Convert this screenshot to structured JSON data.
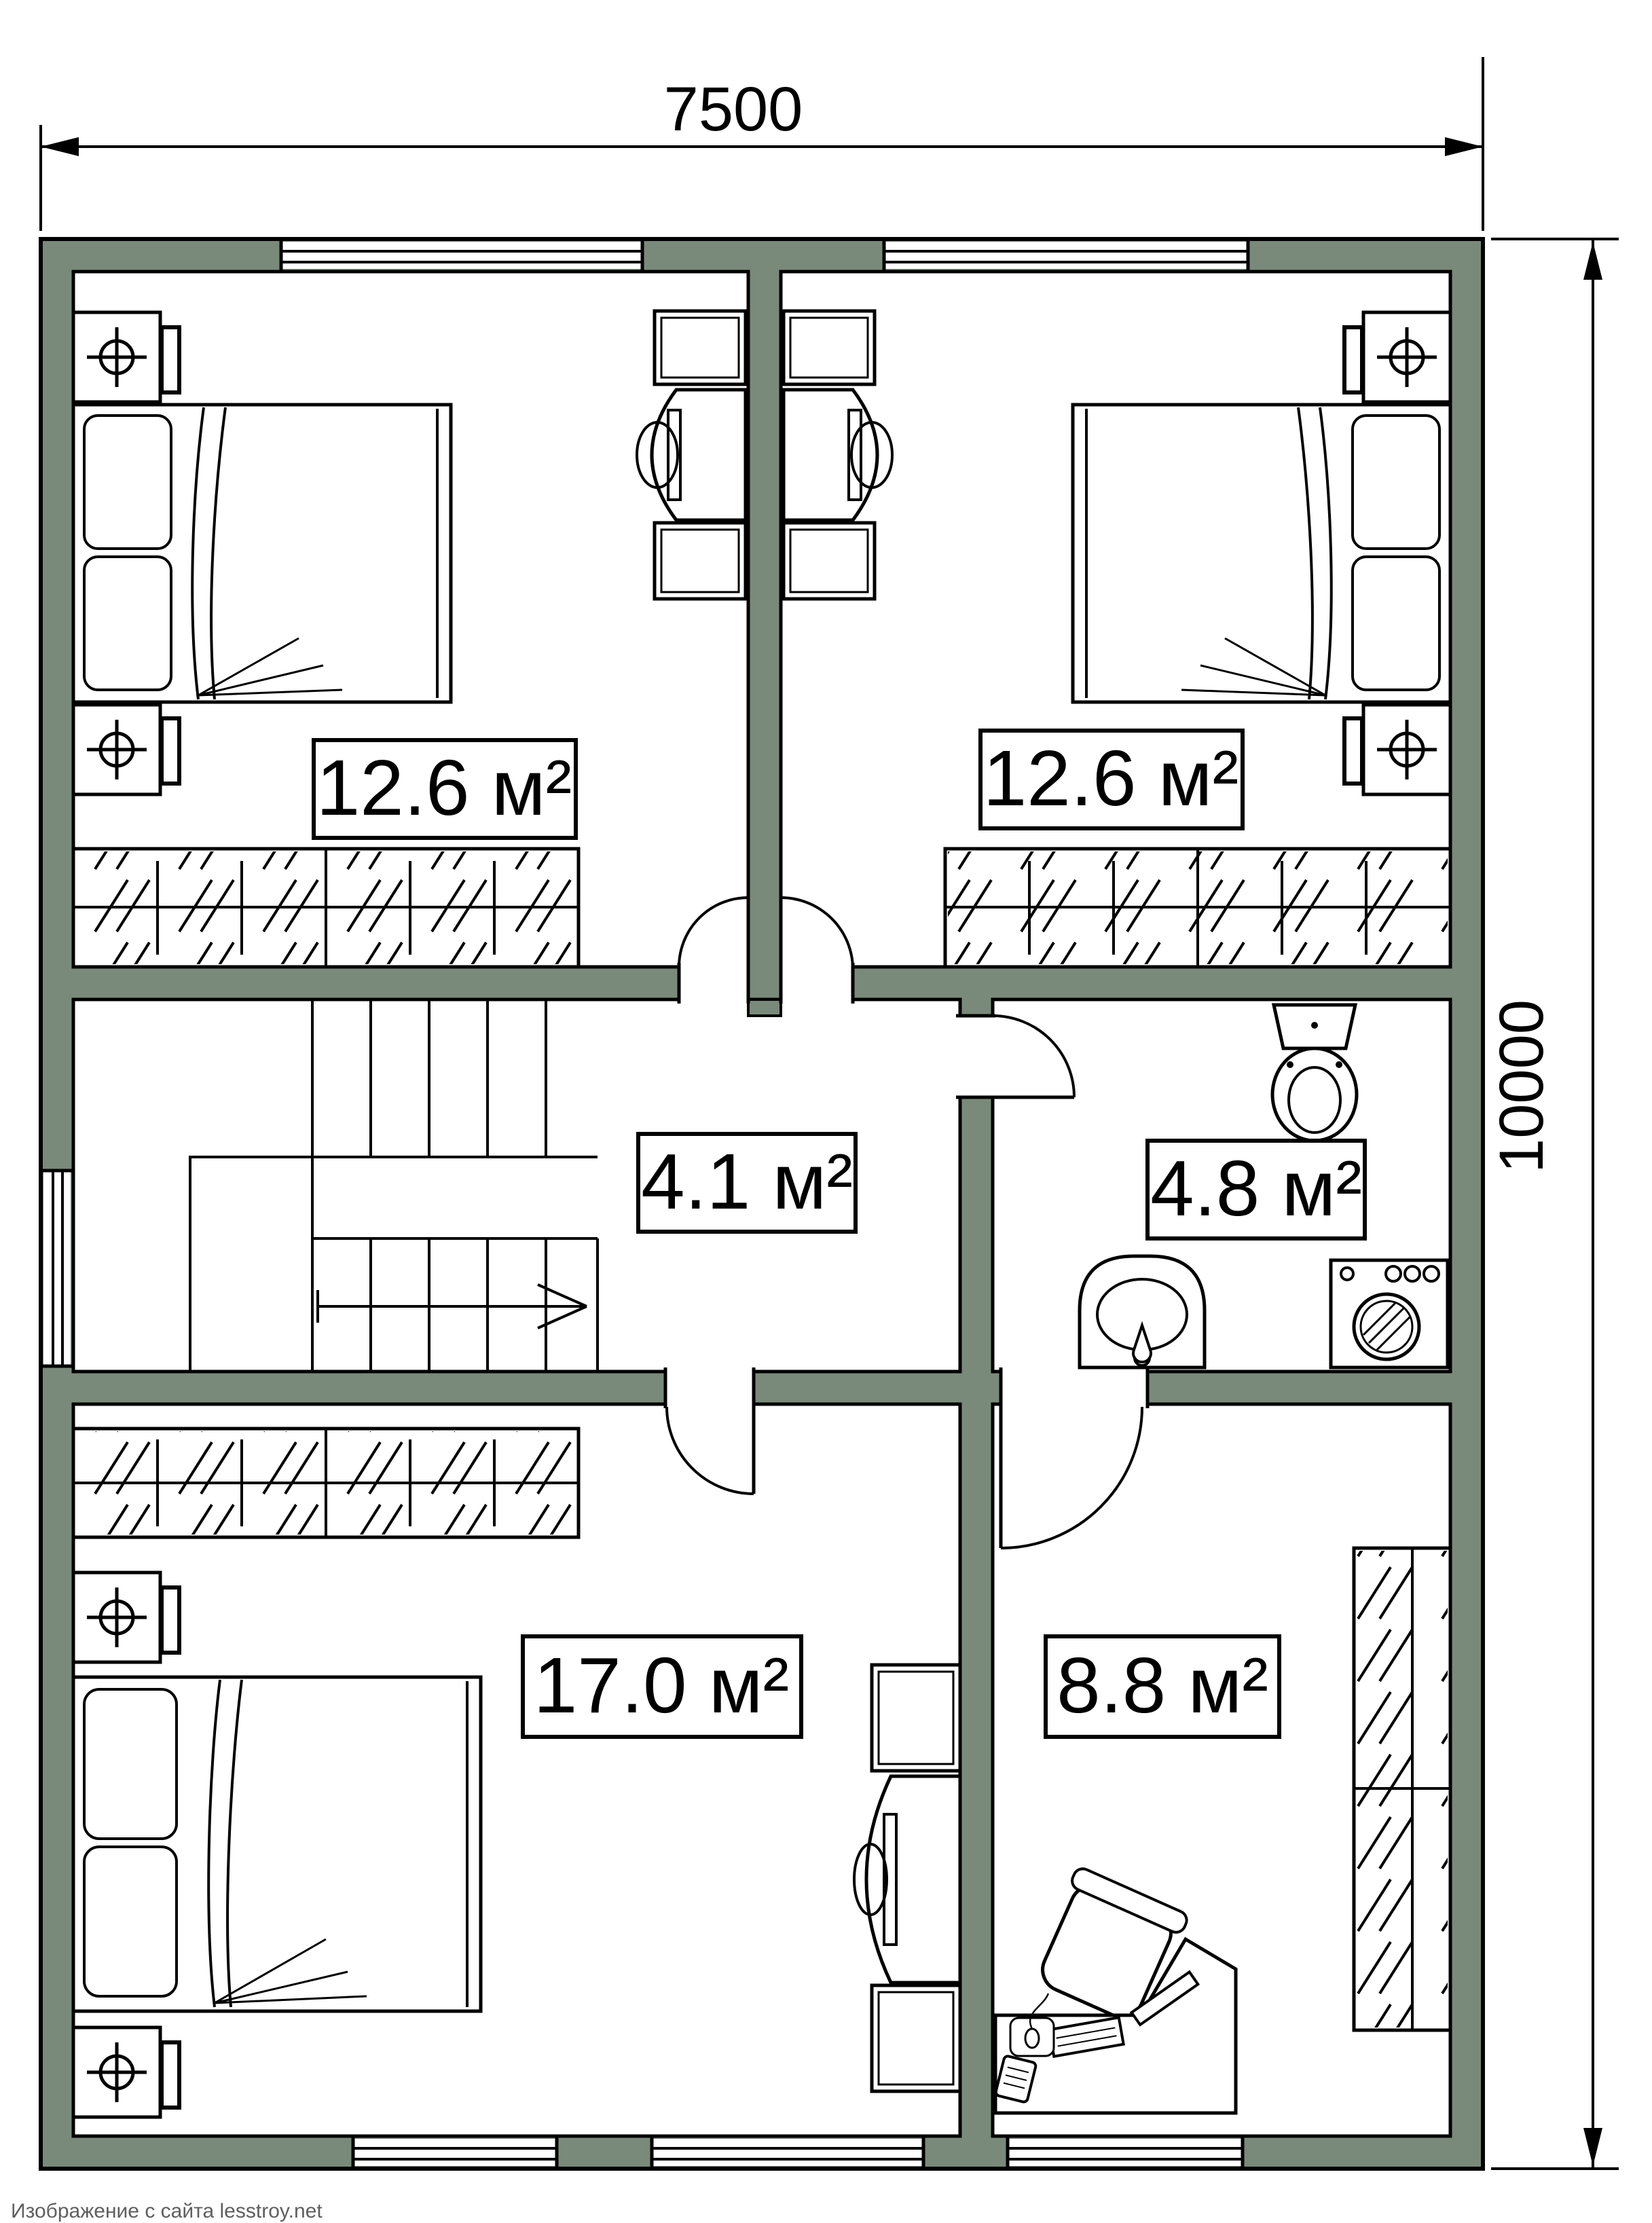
{
  "plan": {
    "type": "floor-plan",
    "dimensions": {
      "width": "7500",
      "height": "10000"
    },
    "rooms": [
      {
        "name": "bedroom-top-left",
        "area_label": "12.6 м²",
        "furniture": [
          "double-bed",
          "nightstand-lamp",
          "nightstand-lamp",
          "sliding-wardrobe",
          "tv-console",
          "cabinet",
          "door"
        ]
      },
      {
        "name": "bedroom-top-right",
        "area_label": "12.6 м²",
        "furniture": [
          "double-bed",
          "nightstand-lamp",
          "nightstand-lamp",
          "sliding-wardrobe",
          "tv-console",
          "cabinet",
          "door"
        ]
      },
      {
        "name": "hall-landing",
        "area_label": "4.1 м²",
        "furniture": [
          "staircase",
          "stair-direction-arrow"
        ]
      },
      {
        "name": "bathroom",
        "area_label": "4.8 м²",
        "furniture": [
          "toilet",
          "sink",
          "washing-machine",
          "door"
        ]
      },
      {
        "name": "bedroom-bottom-left",
        "area_label": "17.0 м²",
        "furniture": [
          "double-bed",
          "nightstand-lamp",
          "nightstand-lamp",
          "sliding-wardrobe",
          "tv-console",
          "cabinet",
          "door"
        ]
      },
      {
        "name": "office-bottom-right",
        "area_label": "8.8 м²",
        "furniture": [
          "desk",
          "office-chair",
          "monitor",
          "keyboard",
          "mouse",
          "phone",
          "wardrobe",
          "door"
        ]
      }
    ],
    "watermark": "Изображение с сайта lesstroy.net",
    "colors": {
      "wall_fill": "#7a8a7a",
      "line": "#000000",
      "background": "#ffffff",
      "watermark_text": "#5f5f5f"
    }
  }
}
